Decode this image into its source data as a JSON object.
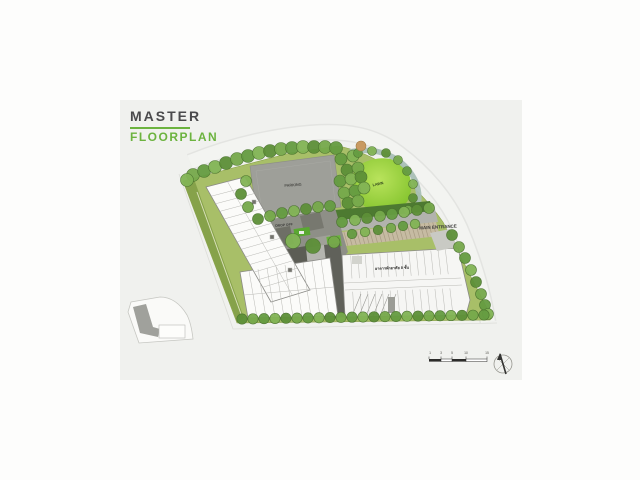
{
  "page": {
    "title": "MASTER",
    "subtitle": "FLOORPLAN"
  },
  "plan": {
    "labels": {
      "parking": "PARKING",
      "lawn": "LAWN",
      "main_entrance": "MAIN ENTRANCE",
      "drop_off": "DROP OFF",
      "building": "อาคารพักอาศัย 8 ชั้น"
    }
  },
  "scale_bar": {
    "ticks": [
      "1",
      "3",
      "5",
      "10",
      "15"
    ]
  },
  "colors": {
    "accent_green": "#6cb33f",
    "title_gray": "#4a4a4c",
    "panel_gray": "#f0f1ee",
    "lawn_green": "#9ed23e",
    "tree_green": "#76a94b",
    "parking_gray": "#9e9f99"
  }
}
